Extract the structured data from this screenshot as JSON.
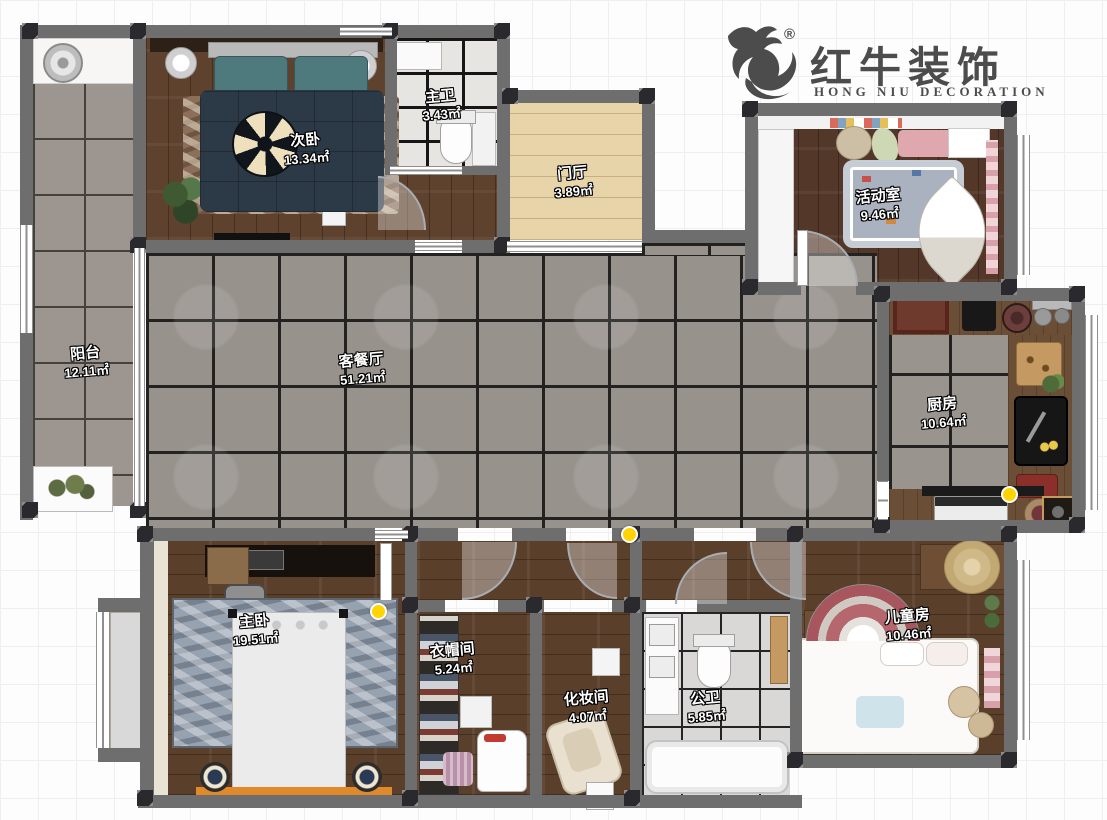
{
  "logo": {
    "brand": "红牛装饰",
    "subtitle": "HONG NIU DECORATION",
    "registered": "®"
  },
  "rooms": [
    {
      "id": "balcony",
      "name": "阳台",
      "area": "12.11㎡"
    },
    {
      "id": "bedroom2",
      "name": "次卧",
      "area": "13.34㎡"
    },
    {
      "id": "master-bath",
      "name": "主卫",
      "area": "3.43㎡"
    },
    {
      "id": "foyer",
      "name": "门厅",
      "area": "3.89㎡"
    },
    {
      "id": "activity",
      "name": "活动室",
      "area": "9.46㎡"
    },
    {
      "id": "living-dining",
      "name": "客餐厅",
      "area": "51.21㎡"
    },
    {
      "id": "kitchen",
      "name": "厨房",
      "area": "10.64㎡"
    },
    {
      "id": "master",
      "name": "主卧",
      "area": "19.51㎡"
    },
    {
      "id": "closet",
      "name": "衣帽间",
      "area": "5.24㎡"
    },
    {
      "id": "makeup",
      "name": "化妆间",
      "area": "4.07㎡"
    },
    {
      "id": "bath2",
      "name": "公卫",
      "area": "5.85㎡"
    },
    {
      "id": "kids",
      "name": "儿童房",
      "area": "10.46㎡"
    }
  ],
  "colors": {
    "wall": "#6e6e6e",
    "column": "#2a2a2e",
    "tile_gray": "#98928d",
    "wood_dark": "#5e422d",
    "wood_light": "#e8d4a9",
    "bath_tile": "#e7e5e2",
    "marker_yellow": "#ffd400",
    "logo_gray": "#4c4c4c",
    "label_text": "#ffffff"
  }
}
